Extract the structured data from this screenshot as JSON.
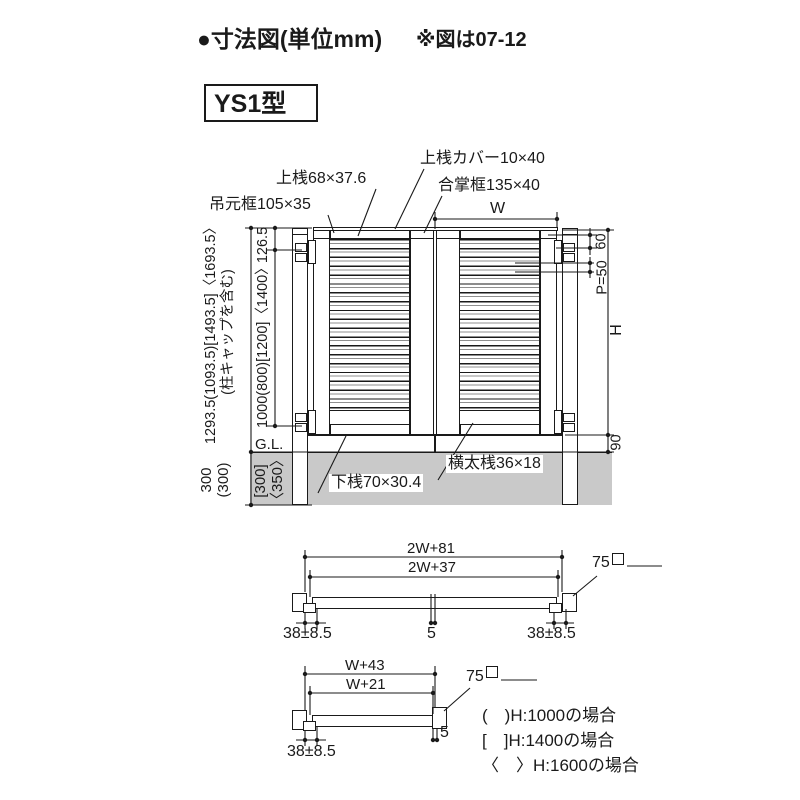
{
  "header": {
    "title": "●寸法図(単位mm)",
    "note": "※図は07-12",
    "model": "YS1型"
  },
  "elevation": {
    "part_labels": {
      "hinge_stile": "吊元框105×35",
      "top_rail": "上桟68×37.6",
      "top_rail_cover": "上桟カバー10×40",
      "meeting_stile": "合掌框135×40",
      "bottom_rail": "下桟70×30.4",
      "cross_rail": "横太桟36×18"
    },
    "dims": {
      "leaf_width": "W",
      "left_total": [
        "1293.5(1093.5)[1493.5]〈1693.5〉",
        "(柱キャップを含む)"
      ],
      "cap_offset": "126.5",
      "hinge_span": "1000(800)[1200]〈1400〉",
      "embed_outer": [
        "300",
        "(300)"
      ],
      "embed_inner": [
        "[300]",
        "〈350〉"
      ],
      "top_to_hinge": "60",
      "louver_pitch": "P=50",
      "gate_height": "H",
      "ground_clearance": "90",
      "ground_line": "G.L."
    }
  },
  "plan_double": {
    "overall_width": "2W+81",
    "inner_width": "2W+37",
    "post_size": "75",
    "left_gap": "38±8.5",
    "center_gap": "5",
    "right_gap": "38±8.5"
  },
  "plan_single": {
    "overall_width": "W+43",
    "inner_width": "W+21",
    "post_size": "75",
    "hinge_gap": "38±8.5",
    "latch_gap": "5"
  },
  "legend": {
    "h1000": "(　)H:1000の場合",
    "h1400": "[　]H:1400の場合",
    "h1600": "〈　〉H:1600の場合"
  },
  "colors": {
    "line": "#1a1a1a",
    "ground": "#c9c9c9"
  }
}
